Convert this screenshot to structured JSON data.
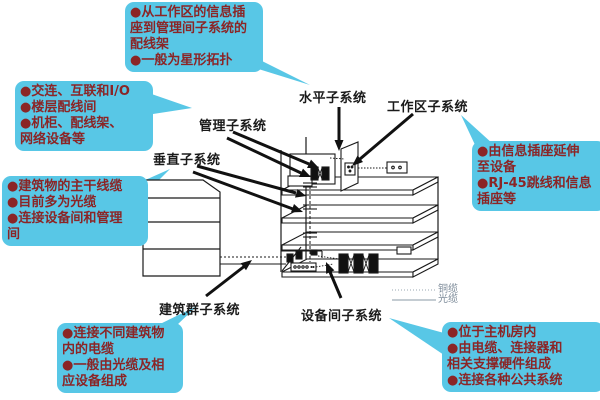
{
  "diagram": {
    "subject": "structured-cabling-subsystems",
    "colors": {
      "background": "#ffffff",
      "callout_bg": "#58C7E6",
      "callout_text": "#8B2526",
      "label_text": "#1a1a1a",
      "drawing_line": "#1a1a1a",
      "legend_text": "#7E8C9A"
    },
    "labels": [
      {
        "id": "horizontal",
        "text": "水平子系统"
      },
      {
        "id": "workarea",
        "text": "工作区子系统"
      },
      {
        "id": "management",
        "text": "管理子系统"
      },
      {
        "id": "vertical",
        "text": "垂直子系统"
      },
      {
        "id": "campus",
        "text": "建筑群子系统"
      },
      {
        "id": "equipment-room",
        "text": "设备间子系统"
      }
    ],
    "callouts": [
      {
        "id": "horizontal-note",
        "lines": [
          "●从工作区的信息插",
          "座到管理间子系统的",
          "配线架",
          "●一般为星形拓扑"
        ]
      },
      {
        "id": "management-note",
        "lines": [
          "●交连、互联和I/O",
          "●楼层配线间",
          "●机柜、配线架、",
          "网络设备等"
        ]
      },
      {
        "id": "vertical-note",
        "lines": [
          "●建筑物的主干线缆",
          "●目前多为光缆",
          "●连接设备间和管理",
          "间"
        ]
      },
      {
        "id": "campus-note",
        "lines": [
          "●连接不同建筑物",
          "内的电缆",
          "●一般由光缆及相",
          "应设备组成"
        ]
      },
      {
        "id": "workarea-note",
        "lines": [
          "●由信息插座延伸",
          "至设备",
          "●RJ-45跳线和信息",
          "插座等"
        ]
      },
      {
        "id": "equipment-room-note",
        "lines": [
          "●位于主机房内",
          "●由电缆、连接器和",
          "相关支撑硬件组成",
          "●连接各种公共系统"
        ]
      }
    ],
    "legend": {
      "copper": "铜缆",
      "fiber": "光缆"
    }
  }
}
